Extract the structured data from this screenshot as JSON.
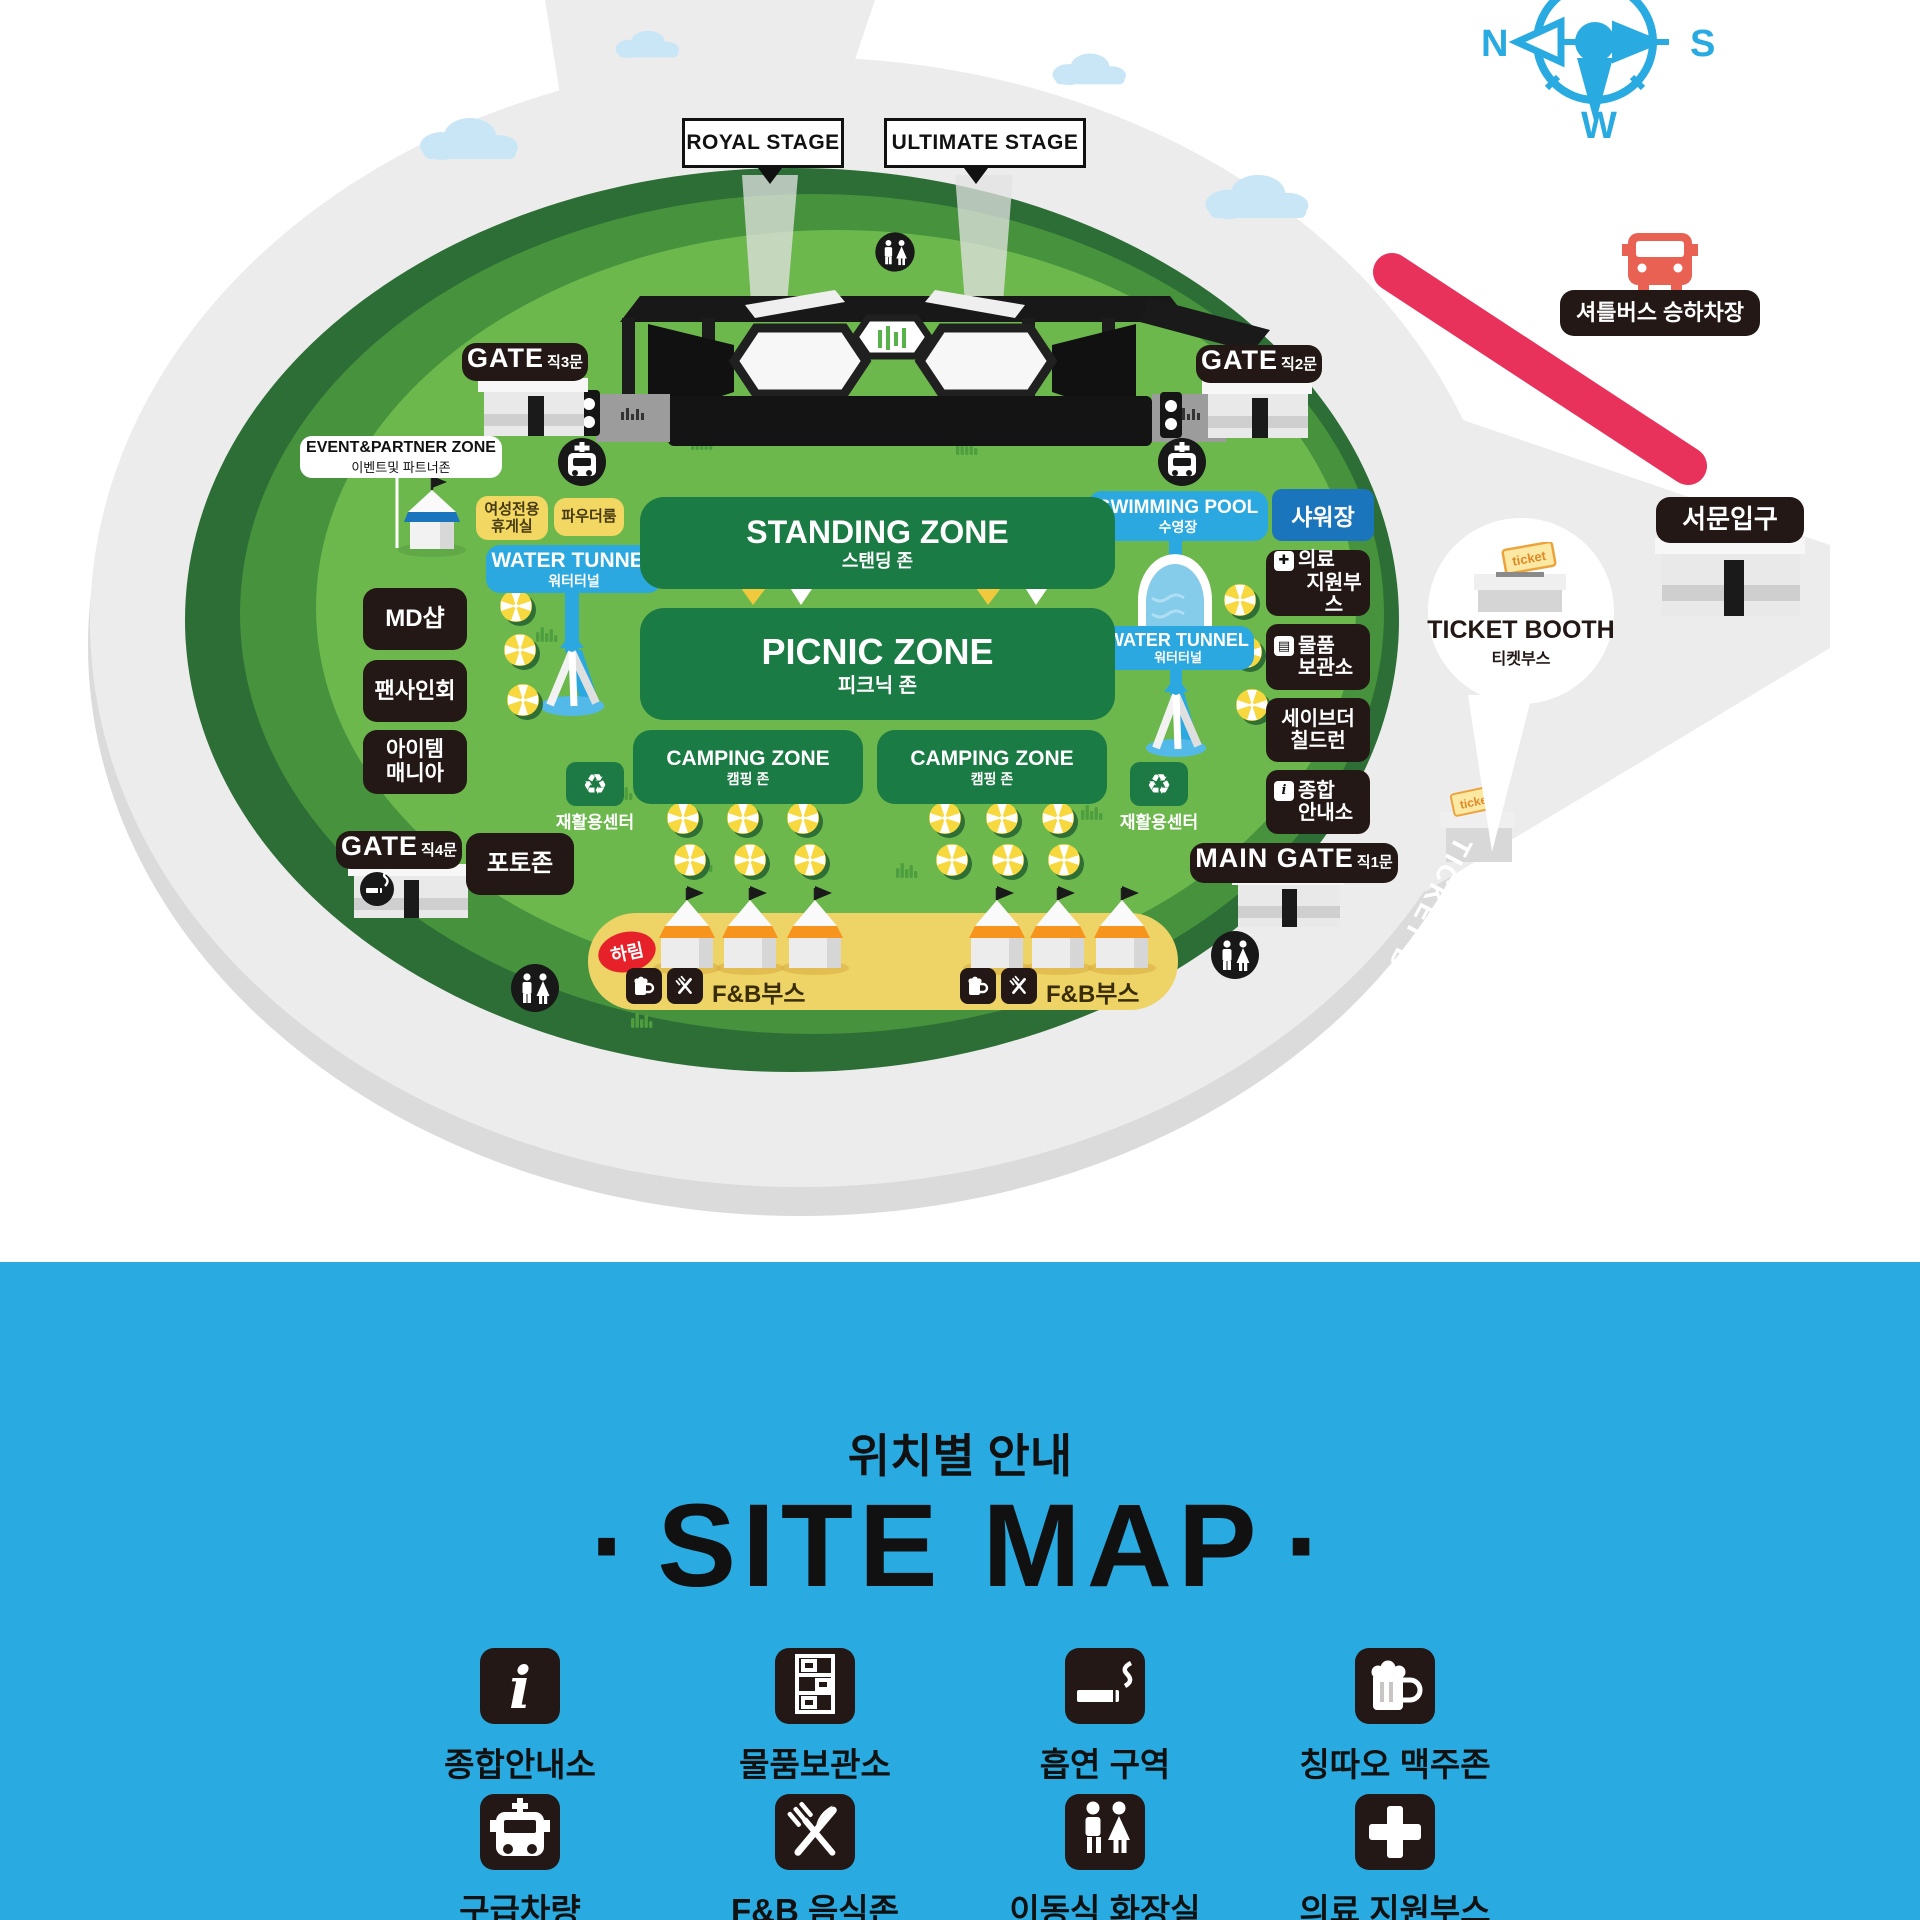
{
  "compass": {
    "n": "N",
    "s": "S",
    "w": "W"
  },
  "stages": {
    "royal": "ROYAL STAGE",
    "ultimate": "ULTIMATE STAGE"
  },
  "gates": {
    "gate3": {
      "name": "GATE",
      "sub": "직3문"
    },
    "gate2": {
      "name": "GATE",
      "sub": "직2문"
    },
    "gate4": {
      "name": "GATE",
      "sub": "직4문"
    },
    "main": {
      "name": "MAIN GATE",
      "sub": "직1문"
    },
    "west": {
      "name": "서문입구"
    }
  },
  "shuttle": {
    "label": "셔틀버스 승하차장"
  },
  "event_zone": {
    "line1": "EVENT&PARTNER ZONE",
    "line2": "이벤트및 파트너존"
  },
  "amenities": {
    "female_rest": {
      "line1": "여성전용",
      "line2": "휴게실"
    },
    "powder_room": "파우더룸",
    "water_tunnel": {
      "en": "WATER TUNNEL",
      "ko": "워터터널"
    },
    "swimming_pool": {
      "en": "SWIMMING POOL",
      "ko": "수영장"
    },
    "shower": "샤워장"
  },
  "left_labels": {
    "md_shop": "MD샵",
    "fan_sign": "팬사인회",
    "item_mania": {
      "line1": "아이템",
      "line2": "매니아"
    },
    "photo_zone": "포토존"
  },
  "right_labels": {
    "medical": {
      "line1": "의료",
      "line2": "지원부스"
    },
    "storage": {
      "line1": "물품",
      "line2": "보관소"
    },
    "save_children": {
      "line1": "세이브더",
      "line2": "칠드런"
    },
    "info": {
      "line1": "종합",
      "line2": "안내소"
    }
  },
  "zones": {
    "standing": {
      "en": "STANDING ZONE",
      "ko": "스탠딩 존"
    },
    "picnic": {
      "en": "PICNIC ZONE",
      "ko": "피크닉 존"
    },
    "camping1": {
      "en": "CAMPING ZONE",
      "ko": "캠핑 존"
    },
    "camping2": {
      "en": "CAMPING ZONE",
      "ko": "캠핑 존"
    }
  },
  "recycle": {
    "label": "재활용센터"
  },
  "fnb": {
    "booth": "F&B부스",
    "brand": "하림"
  },
  "ticket": {
    "booth_en": "TICKET BOOTH",
    "booth_ko": "티켓부스",
    "tag": "ticket",
    "road": "TICKET BOOTH"
  },
  "title": {
    "ko": "위치별 안내",
    "en": "SITE MAP",
    "dot": "·"
  },
  "legend": {
    "items": [
      {
        "label": "종합안내소",
        "icon": "info-icon"
      },
      {
        "label": "물품보관소",
        "icon": "locker-icon"
      },
      {
        "label": "흡연 구역",
        "icon": "smoking-icon"
      },
      {
        "label": "칭따오 맥주존",
        "icon": "beer-icon"
      },
      {
        "label": "구급차량",
        "icon": "ambulance-icon"
      },
      {
        "label": "F&B 음식존",
        "icon": "food-icon"
      },
      {
        "label": "이동식 화장실",
        "icon": "restroom-icon"
      },
      {
        "label": "의료 지원부스",
        "icon": "medical-icon"
      }
    ]
  },
  "colors": {
    "blue_band": "#29ABE2",
    "field_green": "#6CB84D",
    "ring_green": "#47923C",
    "outer_green": "#2C6E35",
    "panel_green": "#1B7B44",
    "label_black": "#231815",
    "accent_red": "#E8315B",
    "label_yellow": "#F3D763",
    "cyan": "#2AA8DF",
    "shower_blue": "#1B75BC",
    "island_gray": "#ECECEC"
  }
}
